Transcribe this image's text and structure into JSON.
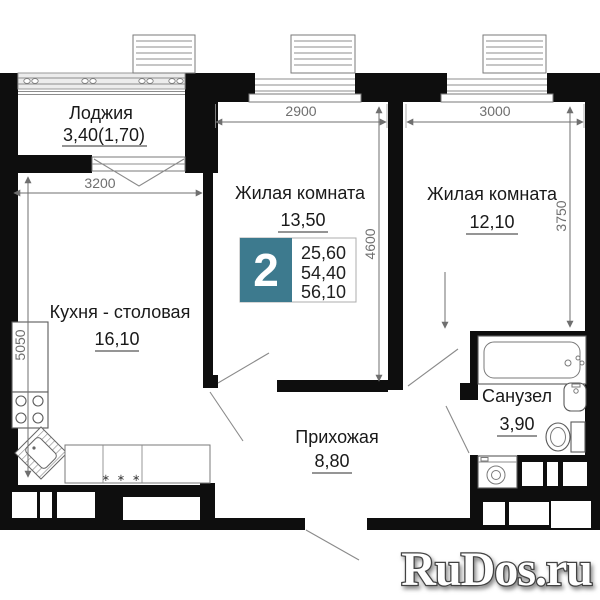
{
  "rooms": [
    {
      "name": "Лоджия",
      "area": "3,40(1,70)"
    },
    {
      "name": "Жилая комната",
      "area": "13,50"
    },
    {
      "name": "Жилая комната",
      "area": "12,10"
    },
    {
      "name": "Кухня - столовая",
      "area": "16,10"
    },
    {
      "name": "Прихожая",
      "area": "8,80"
    },
    {
      "name": "Санузел",
      "area": "3,90"
    }
  ],
  "badge": {
    "rooms_count": "2",
    "areas": [
      "25,60",
      "54,40",
      "56,10"
    ],
    "accent_color": "#3d7a8e"
  },
  "dimensions_mm": {
    "loggia_width": "3200",
    "kitchen_depth": "5050",
    "living1_width": "2900",
    "living1_depth": "4600",
    "living2_width": "3000",
    "living2_depth": "3750"
  },
  "symbols": {
    "counter_marks": "∗ ∗ ∗"
  },
  "watermark": "RuDos.ru",
  "colors": {
    "wall": "#0e0e0e",
    "dimension": "#6f6f6f",
    "label": "#191919"
  }
}
